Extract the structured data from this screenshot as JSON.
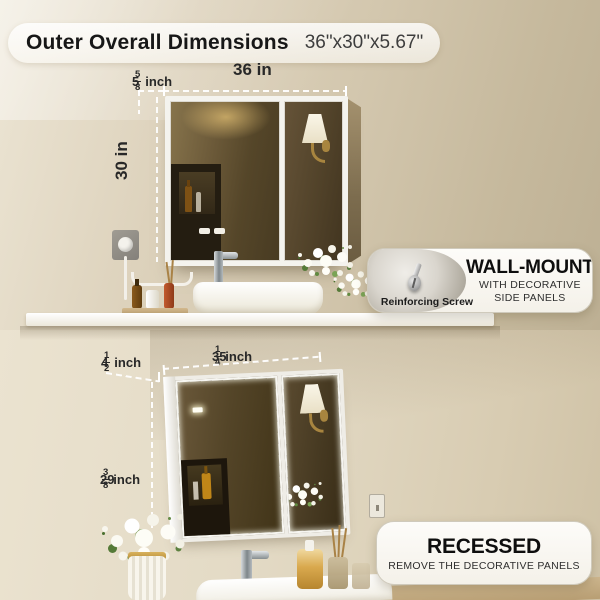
{
  "header": {
    "title": "Outer Overall Dimensions",
    "size_text": "36\"x30\"x5.67\""
  },
  "wall_mount_section": {
    "width_label": "36 in",
    "height_label": "30 in",
    "depth": {
      "whole": "5",
      "numerator": "5",
      "denominator": "8",
      "unit": "inch"
    },
    "callout": {
      "photo_caption": "Reinforcing Screw",
      "title": "WALL-MOUNT",
      "line1": "WITH DECORATIVE",
      "line2": "SIDE PANELS"
    }
  },
  "recessed_section": {
    "width": {
      "whole": "35",
      "numerator": "1",
      "denominator": "4",
      "unit": "inch"
    },
    "depth": {
      "whole": "4",
      "numerator": "1",
      "denominator": "2",
      "unit": "inch"
    },
    "height": {
      "whole": "29",
      "numerator": "3",
      "denominator": "8",
      "unit": "inch"
    },
    "callout": {
      "title": "RECESSED",
      "subtitle": "REMOVE THE DECORATIVE PANELS"
    }
  },
  "colors": {
    "wall_beige": "#d8cdb6",
    "frame_white": "#f4f3ee",
    "mirror_brown": "#554629",
    "gold_accent": "#a8853f",
    "text_dark": "#1c1c1c"
  }
}
